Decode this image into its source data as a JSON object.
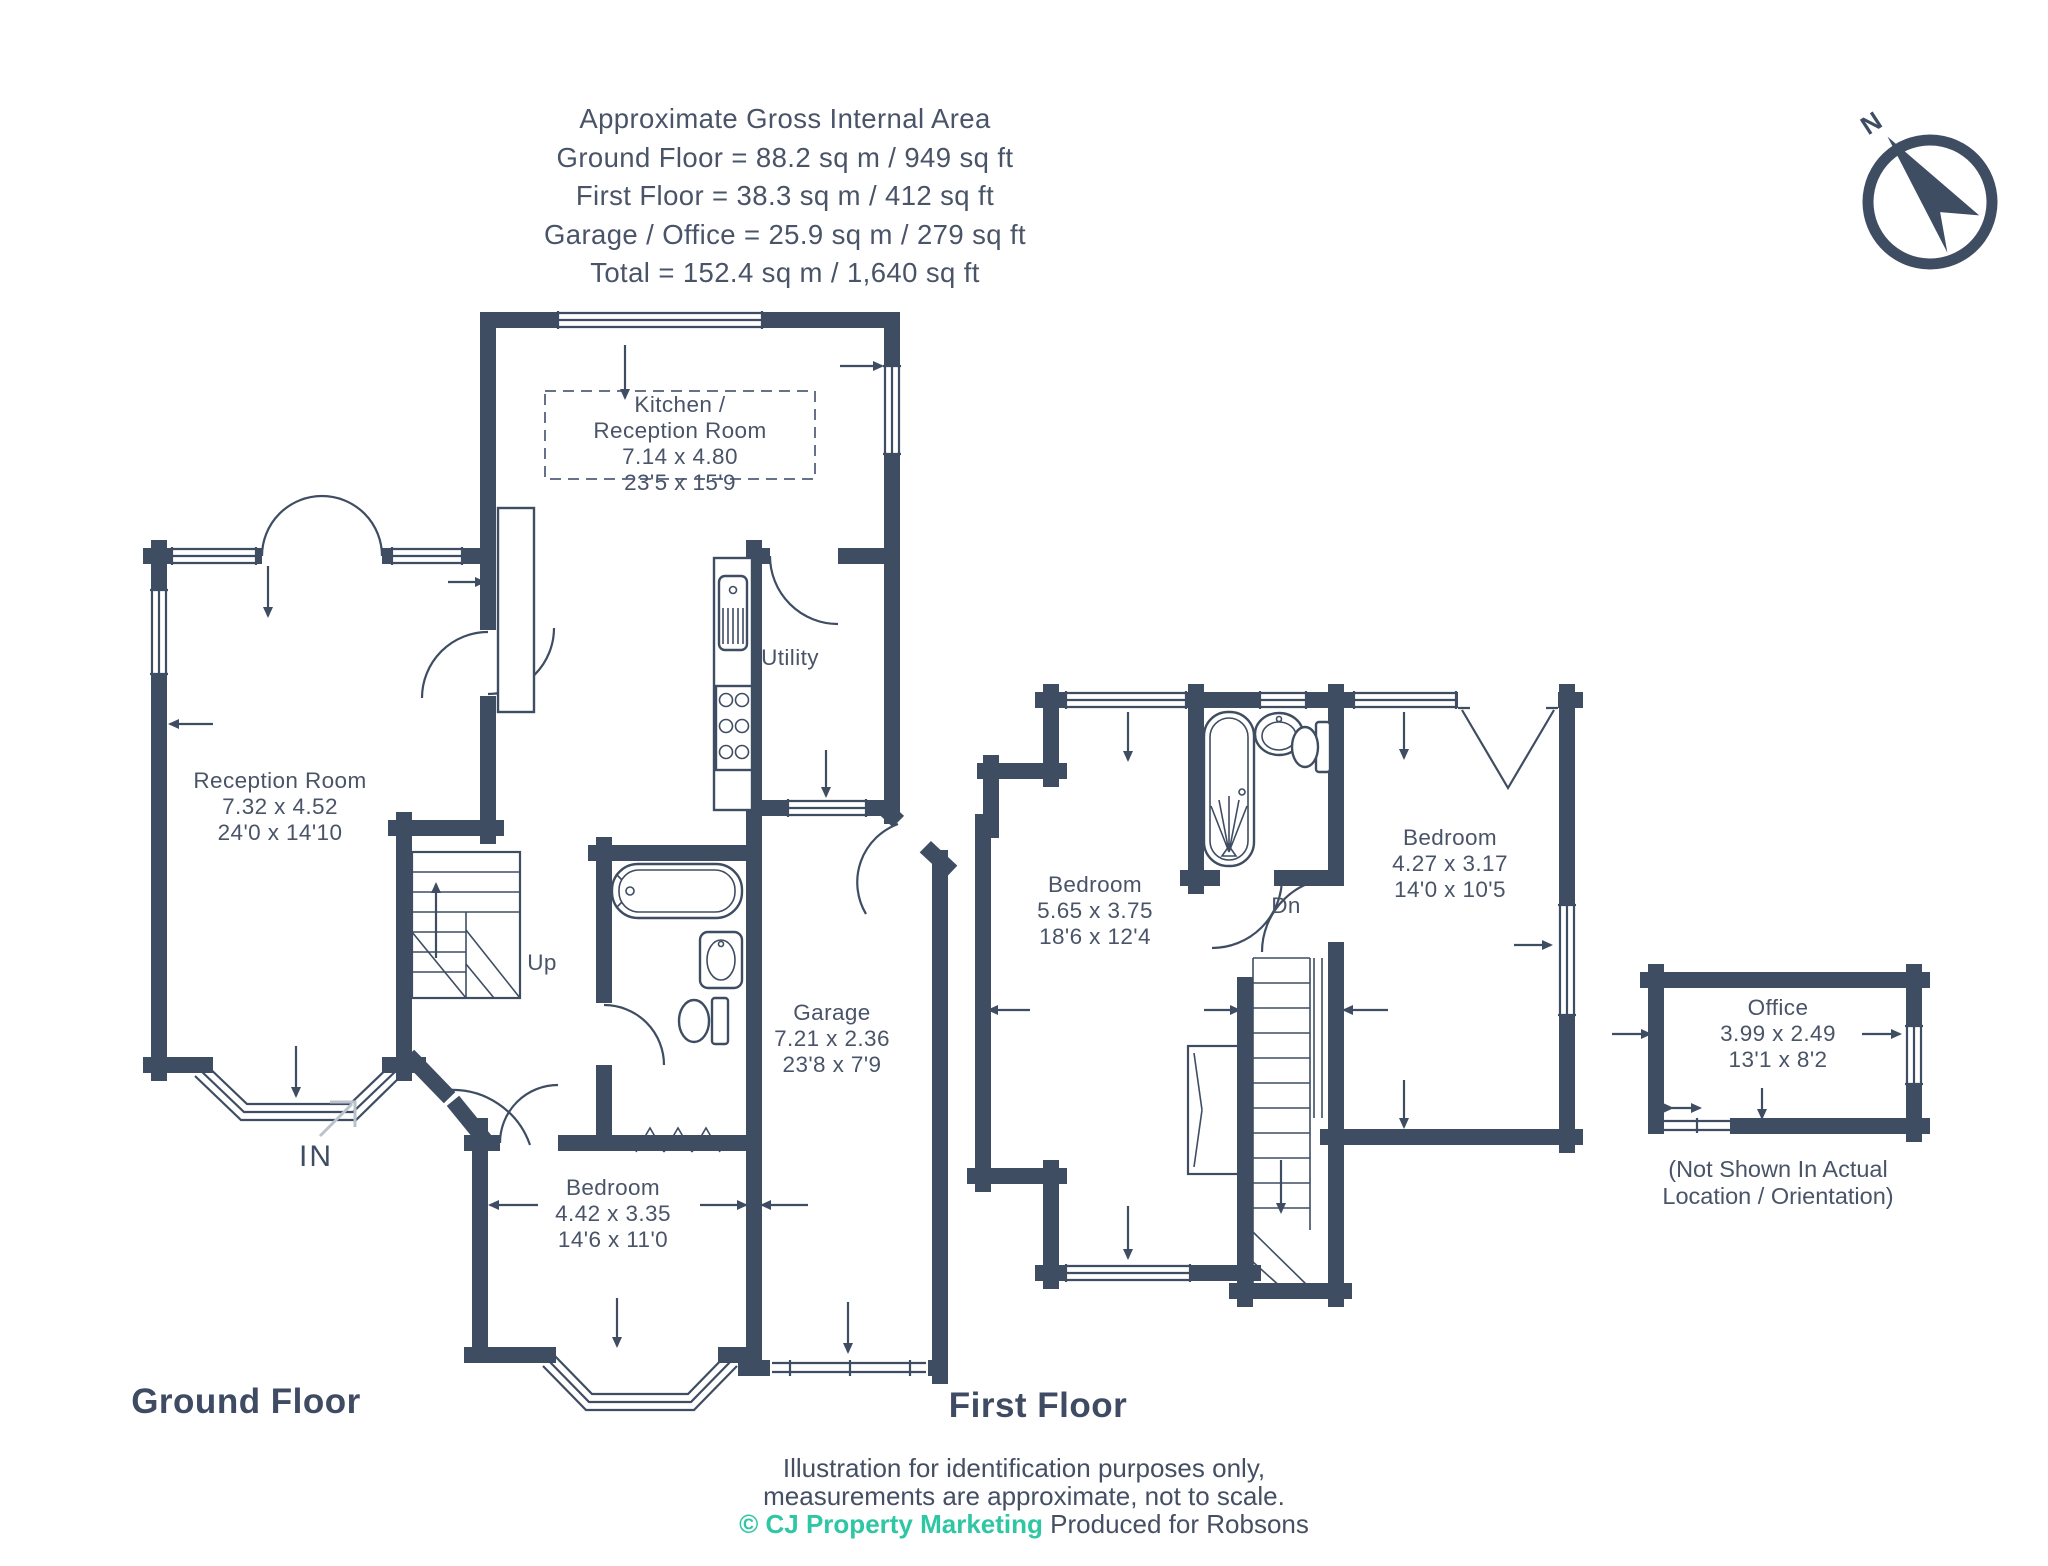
{
  "colors": {
    "wall": "#3f4d63",
    "text": "#4a5468",
    "teal": "#2fc6a4"
  },
  "header": {
    "title": "Approximate Gross Internal Area",
    "ground": "Ground Floor = 88.2 sq m / 949 sq ft",
    "first": "First Floor = 38.3 sq m / 412 sq ft",
    "garage": "Garage / Office = 25.9 sq m / 279 sq ft",
    "total": "Total = 152.4 sq m / 1,640 sq ft"
  },
  "compass": {
    "north": "N"
  },
  "ground_floor": {
    "label": "Ground Floor",
    "stairs": "Up",
    "entrance": "IN",
    "rooms": {
      "kitchen": {
        "name1": "Kitchen /",
        "name2": "Reception Room",
        "metric": "7.14 x 4.80",
        "imperial": "23'5 x 15'9"
      },
      "reception": {
        "name": "Reception Room",
        "metric": "7.32 x 4.52",
        "imperial": "24'0 x 14'10"
      },
      "utility": {
        "name": "Utility"
      },
      "garage": {
        "name": "Garage",
        "metric": "7.21 x 2.36",
        "imperial": "23'8 x 7'9"
      },
      "bedroom": {
        "name": "Bedroom",
        "metric": "4.42 x 3.35",
        "imperial": "14'6 x 11'0"
      }
    }
  },
  "first_floor": {
    "label": "First Floor",
    "stairs": "Dn",
    "rooms": {
      "bedroom_left": {
        "name": "Bedroom",
        "metric": "5.65 x 3.75",
        "imperial": "18'6 x 12'4"
      },
      "bedroom_right": {
        "name": "Bedroom",
        "metric": "4.27 x 3.17",
        "imperial": "14'0 x 10'5"
      }
    }
  },
  "office": {
    "name": "Office",
    "metric": "3.99 x 2.49",
    "imperial": "13'1 x 8'2",
    "note1": "(Not Shown In Actual",
    "note2": "Location / Orientation)"
  },
  "footer": {
    "line1": "Illustration for identification purposes only,",
    "line2": "measurements are approximate, not to scale.",
    "copyright": "© CJ Property Marketing",
    "produced": "Produced for Robsons"
  }
}
